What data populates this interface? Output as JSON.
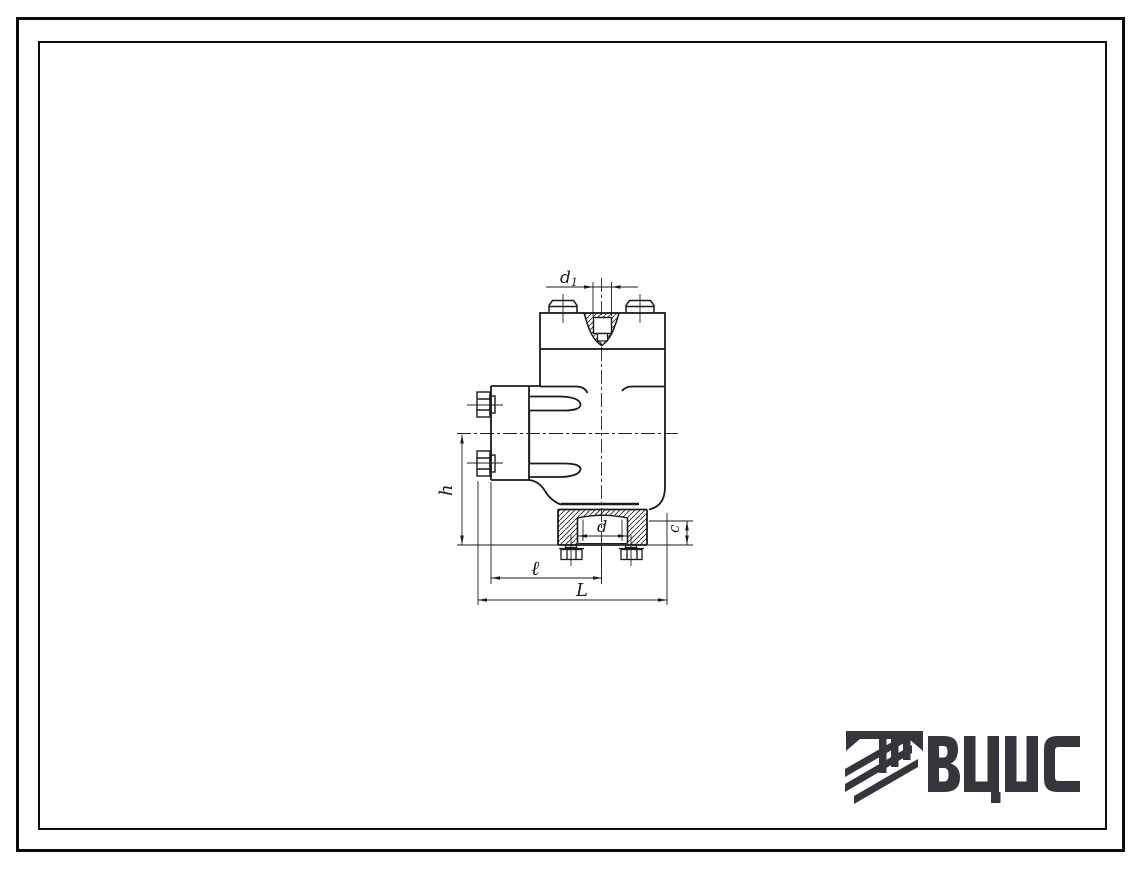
{
  "page": {
    "background_color": "#ffffff",
    "frame_color": "#0c0c0c",
    "description": "Scanned typical-design sheet: sectional technical drawing of a flanged valve body with dimension callouts, double ruled border, VCIS logotype bottom-right"
  },
  "drawing": {
    "line_color": "#1b1b1b",
    "labels": {
      "d1_base": "d",
      "d1_sub": "1",
      "h": "h",
      "l": "ℓ",
      "L": "L",
      "c": "c",
      "d": "d"
    }
  },
  "logo": {
    "text": "ВЦИС",
    "letters": [
      "В",
      "Ц",
      "И",
      "С"
    ],
    "color": "#35353c",
    "emblem": "column-capital-with-three-diagonal-stripes"
  }
}
